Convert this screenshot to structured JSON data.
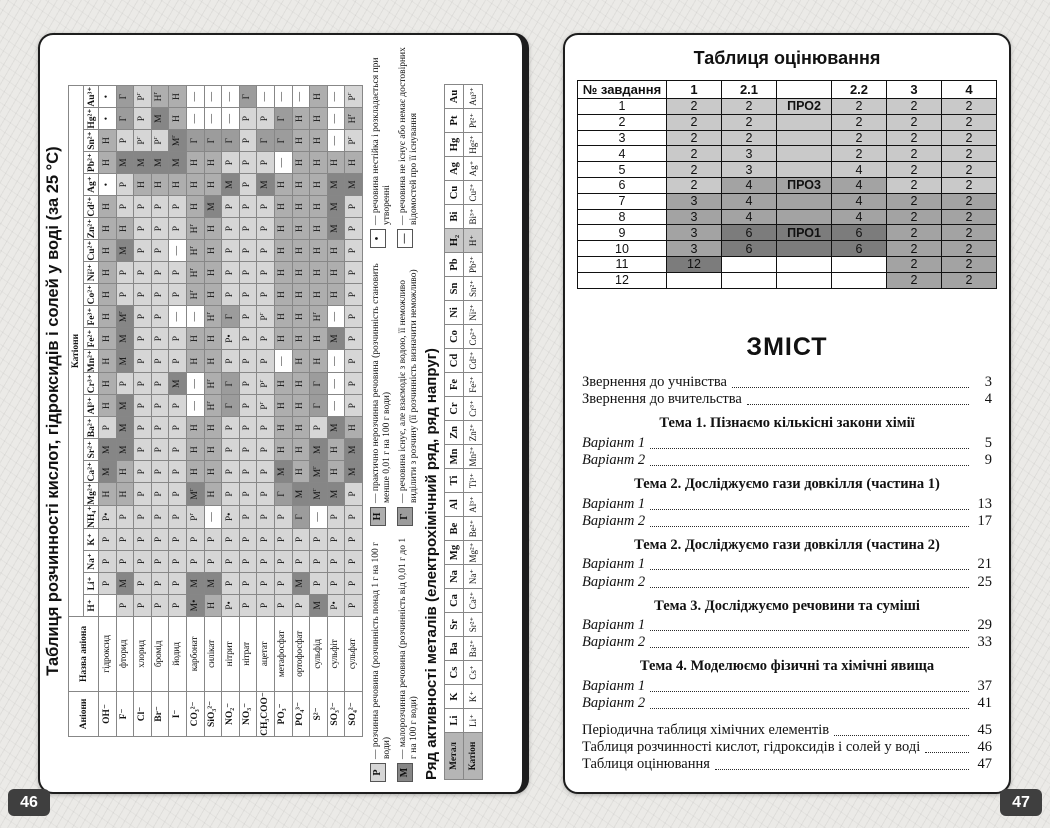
{
  "page_left": {
    "page_number": "46",
    "solubility": {
      "title": "Таблиця розчинності кислот, гідроксидів і солей у воді (за 25 °С)",
      "cations_header": "Катіони",
      "anions_header": "Аніони",
      "anion_name_header": "Назва аніона",
      "cations": [
        "H⁺",
        "Li⁺",
        "Na⁺",
        "K⁺",
        "NH₄⁺",
        "Mg²⁺",
        "Ca²⁺",
        "Sr²⁺",
        "Ba²⁺",
        "Al³⁺",
        "Cr³⁺",
        "Mn²⁺",
        "Fe²⁺",
        "Fe³⁺",
        "Co²⁺",
        "Ni²⁺",
        "Cu²⁺",
        "Zn²⁺",
        "Cd²⁺",
        "Ag⁺",
        "Pb²⁺",
        "Sn²⁺",
        "Hg²⁺",
        "Au³⁺"
      ],
      "rows": [
        {
          "formula": "OH⁻",
          "name": "гідроксид",
          "cells": [
            "",
            "Р",
            "Р",
            "Р",
            "Р•",
            "Н",
            "М",
            "М",
            "Р",
            "Н",
            "Н",
            "Н",
            "Н",
            "Н",
            "Н",
            "Н",
            "Н",
            "Н",
            "Н",
            "•",
            "Н",
            "Н",
            "•",
            "•"
          ]
        },
        {
          "formula": "F⁻",
          "name": "фторид",
          "cells": [
            "Р",
            "М",
            "Р",
            "Р",
            "Р",
            "Н",
            "Н",
            "М",
            "М",
            "М",
            "Р",
            "М",
            "М",
            "Мг",
            "Р",
            "Р",
            "М",
            "Н",
            "Р",
            "Р",
            "М",
            "Р",
            "Г",
            "Г"
          ]
        },
        {
          "formula": "Cl⁻",
          "name": "хлорид",
          "cells": [
            "Р",
            "Р",
            "Р",
            "Р",
            "Р",
            "Р",
            "Р",
            "Р",
            "Р",
            "Р",
            "Р",
            "Р",
            "Р",
            "Р",
            "Р",
            "Р",
            "Р",
            "Р",
            "Р",
            "Н",
            "М",
            "Рг",
            "Р",
            "Рг"
          ]
        },
        {
          "formula": "Br⁻",
          "name": "бромід",
          "cells": [
            "Р",
            "Р",
            "Р",
            "Р",
            "Р",
            "Р",
            "Р",
            "Р",
            "Р",
            "Р",
            "Р",
            "Р",
            "Р",
            "Р",
            "Р",
            "Р",
            "Р",
            "Р",
            "Р",
            "Н",
            "М",
            "Рг",
            "М",
            "Нг"
          ]
        },
        {
          "formula": "I⁻",
          "name": "йодид",
          "cells": [
            "Р",
            "Р",
            "Р",
            "Р",
            "Р",
            "Р",
            "Р",
            "Р",
            "Р",
            "Р",
            "М",
            "Р",
            "Р",
            "—",
            "Р",
            "Р",
            "—",
            "Р",
            "Р",
            "Н",
            "М",
            "Мг",
            "Н",
            "Н"
          ]
        },
        {
          "formula": "CO₃²⁻",
          "name": "карбонат",
          "cells": [
            "М•",
            "М",
            "Р",
            "Р",
            "Рг",
            "Мг",
            "Н",
            "Н",
            "Н",
            "—",
            "—",
            "Н",
            "Н",
            "—",
            "Нг",
            "Нг",
            "Нг",
            "Нг",
            "Н",
            "Н",
            "Н",
            "Г",
            "—",
            "—"
          ]
        },
        {
          "formula": "SiO₃²⁻",
          "name": "силікат",
          "cells": [
            "Н",
            "М",
            "Р",
            "Р",
            "—",
            "Н",
            "Н",
            "Н",
            "Н",
            "Нг",
            "Нг",
            "Н",
            "Н",
            "Нг",
            "Н",
            "Н",
            "Н",
            "Н",
            "М",
            "Н",
            "Н",
            "Г",
            "—",
            "—"
          ]
        },
        {
          "formula": "NO₂⁻",
          "name": "нітрит",
          "cells": [
            "Р•",
            "Р",
            "Р",
            "Р",
            "Р•",
            "Р",
            "Р",
            "Р",
            "Р",
            "Г",
            "Г",
            "Р",
            "Р•",
            "Г",
            "Р",
            "Р",
            "Р",
            "Р",
            "Р",
            "М",
            "Р",
            "Г",
            "—",
            "—"
          ]
        },
        {
          "formula": "NO₃⁻",
          "name": "нітрат",
          "cells": [
            "Р",
            "Р",
            "Р",
            "Р",
            "Р",
            "Р",
            "Р",
            "Р",
            "Р",
            "Р",
            "Р",
            "Р",
            "Р",
            "Р",
            "Р",
            "Р",
            "Р",
            "Р",
            "Р",
            "Р",
            "Р",
            "Р",
            "Р",
            "Г"
          ]
        },
        {
          "formula": "CH₃COO⁻",
          "name": "ацетат",
          "cells": [
            "Р",
            "Р",
            "Р",
            "Р",
            "Р",
            "Р",
            "Р",
            "Р",
            "Р",
            "Рг",
            "Рг",
            "Р",
            "Р",
            "Рг",
            "Р",
            "Р",
            "Р",
            "Р",
            "Р",
            "М",
            "Р",
            "Г",
            "Р",
            "—"
          ]
        },
        {
          "formula": "PO₃⁻",
          "name": "метафосфат",
          "cells": [
            "Р",
            "Р",
            "Р",
            "Р",
            "Р",
            "Г",
            "М",
            "Н",
            "Н",
            "Н",
            "Н",
            "—",
            "Н",
            "Н",
            "Н",
            "Н",
            "Н",
            "Н",
            "Н",
            "Н",
            "—",
            "Г",
            "Г",
            "—"
          ]
        },
        {
          "formula": "PO₄³⁻",
          "name": "ортофосфат",
          "cells": [
            "Р",
            "М",
            "Р",
            "Р",
            "Г",
            "М",
            "Н",
            "Н",
            "Н",
            "Н",
            "Н",
            "Н",
            "Н",
            "Н",
            "Н",
            "Н",
            "Н",
            "Н",
            "Н",
            "Н",
            "Н",
            "Н",
            "Н",
            "—"
          ]
        },
        {
          "formula": "S²⁻",
          "name": "сульфід",
          "cells": [
            "М",
            "Р",
            "Р",
            "Р",
            "—",
            "Мг",
            "Мг",
            "М",
            "Р",
            "Г",
            "Г",
            "Н",
            "Н",
            "Нг",
            "Н",
            "Н",
            "Н",
            "Н",
            "Н",
            "Н",
            "Н",
            "Н",
            "Н",
            "Н"
          ]
        },
        {
          "formula": "SO₃²⁻",
          "name": "сульфіт",
          "cells": [
            "Р•",
            "Р",
            "Р",
            "Р",
            "Р",
            "М",
            "Н",
            "Н",
            "М",
            "—",
            "—",
            "—",
            "М",
            "—",
            "Н",
            "Н",
            "Н",
            "М",
            "М",
            "М",
            "Н",
            "—",
            "—",
            "—"
          ]
        },
        {
          "formula": "SO₄²⁻",
          "name": "сульфат",
          "cells": [
            "Р",
            "Р",
            "Р",
            "Р",
            "Р",
            "Р",
            "М",
            "М",
            "Н",
            "Р",
            "Р",
            "Р",
            "Р",
            "Р",
            "Р",
            "Р",
            "Р",
            "Р",
            "Р",
            "М",
            "Н",
            "Рг",
            "Нг",
            "Рг"
          ]
        }
      ],
      "value_colors": {
        "Р": "#d6d6d6",
        "М": "#868686",
        "Н": "#aeaeae",
        "Г": "#9c9c9c"
      },
      "legend": [
        {
          "symbol": "Р",
          "color": "#d6d6d6",
          "text": "— розчинна речовина (розчинність понад 1 г на 100 г води)"
        },
        {
          "symbol": "М",
          "color": "#868686",
          "text": "— малорозчинна речовина (розчинність від 0,01 г до 1 г на 100 г води)"
        },
        {
          "symbol": "Н",
          "color": "#aeaeae",
          "text": "— практично нерозчинна речовина (розчинність становить менше 0,01 г на 100 г води)"
        },
        {
          "symbol": "Г",
          "color": "#9c9c9c",
          "text": "— речовина існує, але взаємодіє з водою, її неможливо виділити з розчину (її розчинність визначити неможливо)"
        },
        {
          "symbol": "•",
          "color": "#ffffff",
          "text": "— речовина нестійка і розкладається при утворенні"
        },
        {
          "symbol": "—",
          "color": "#ffffff",
          "text": "— речовина не існує або немає достовірних відомостей про її існування"
        }
      ]
    },
    "activity": {
      "title": "Ряд активності металів (електрохімічний ряд, ряд напруг)",
      "metal_label": "Метал",
      "cation_label": "Катіон",
      "metals": [
        "Li",
        "K",
        "Cs",
        "Ba",
        "Sr",
        "Ca",
        "Na",
        "Mg",
        "Be",
        "Al",
        "Ti",
        "Mn",
        "Zn",
        "Cr",
        "Fe",
        "Cd",
        "Co",
        "Ni",
        "Sn",
        "Pb",
        "H₂",
        "Bi",
        "Cu",
        "Ag",
        "Hg",
        "Pt",
        "Au"
      ],
      "ions": [
        "Li⁺",
        "K⁺",
        "Cs⁺",
        "Ba²⁺",
        "Sr²⁺",
        "Ca²⁺",
        "Na⁺",
        "Mg²⁺",
        "Be²⁺",
        "Al³⁺",
        "Ti³⁺",
        "Mn²⁺",
        "Zn²⁺",
        "Cr³⁺",
        "Fe²⁺",
        "Cd²⁺",
        "Co²⁺",
        "Ni²⁺",
        "Sn²⁺",
        "Pb²⁺",
        "H⁺",
        "Bi³⁺",
        "Cu²⁺",
        "Ag⁺",
        "Hg²⁺",
        "Pt²⁺",
        "Au³⁺"
      ],
      "highlight_index": 20
    }
  },
  "page_right": {
    "page_number": "47",
    "grading": {
      "title": "Таблиця оцінювання",
      "headers": [
        "№ завдання",
        "1",
        "2.1",
        "",
        "2.2",
        "3",
        "4"
      ],
      "shade_colors": {
        "l": "#c9c9c9",
        "m": "#a3a3a3",
        "d": "#7c7c7c",
        "w": "#ffffff"
      },
      "rows": [
        {
          "cells": [
            "1",
            "2",
            "2",
            "ПРО2",
            "2",
            "2",
            "2"
          ],
          "shades": [
            "l",
            "l",
            "l",
            "l",
            "l",
            "l"
          ]
        },
        {
          "cells": [
            "2",
            "2",
            "2",
            "",
            "2",
            "2",
            "2"
          ],
          "shades": [
            "l",
            "l",
            "l",
            "l",
            "l",
            "l"
          ]
        },
        {
          "cells": [
            "3",
            "2",
            "2",
            "",
            "2",
            "2",
            "2"
          ],
          "shades": [
            "l",
            "l",
            "l",
            "l",
            "l",
            "l"
          ]
        },
        {
          "cells": [
            "4",
            "2",
            "3",
            "",
            "2",
            "2",
            "2"
          ],
          "shades": [
            "l",
            "l",
            "l",
            "l",
            "l",
            "l"
          ]
        },
        {
          "cells": [
            "5",
            "2",
            "3",
            "",
            "4",
            "2",
            "2"
          ],
          "shades": [
            "l",
            "l",
            "l",
            "l",
            "l",
            "l"
          ]
        },
        {
          "cells": [
            "6",
            "2",
            "4",
            "ПРО3",
            "4",
            "2",
            "2"
          ],
          "shades": [
            "l",
            "m",
            "m",
            "m",
            "l",
            "l"
          ]
        },
        {
          "cells": [
            "7",
            "3",
            "4",
            "",
            "4",
            "2",
            "2"
          ],
          "shades": [
            "m",
            "m",
            "m",
            "m",
            "m",
            "m"
          ]
        },
        {
          "cells": [
            "8",
            "3",
            "4",
            "",
            "4",
            "2",
            "2"
          ],
          "shades": [
            "m",
            "m",
            "m",
            "m",
            "m",
            "m"
          ]
        },
        {
          "cells": [
            "9",
            "3",
            "6",
            "ПРО1",
            "6",
            "2",
            "2"
          ],
          "shades": [
            "m",
            "d",
            "d",
            "d",
            "m",
            "m"
          ]
        },
        {
          "cells": [
            "10",
            "3",
            "6",
            "",
            "6",
            "2",
            "2"
          ],
          "shades": [
            "m",
            "d",
            "d",
            "d",
            "m",
            "m"
          ]
        },
        {
          "cells": [
            "11",
            "12",
            "",
            "",
            "",
            "2",
            "2"
          ],
          "shades": [
            "d",
            "w",
            "w",
            "w",
            "m",
            "m"
          ]
        },
        {
          "cells": [
            "12",
            "",
            "",
            "",
            "",
            "2",
            "2"
          ],
          "shades": [
            "w",
            "w",
            "w",
            "w",
            "m",
            "m"
          ]
        }
      ]
    },
    "toc": {
      "title": "ЗМІСТ",
      "items": [
        {
          "t": "entry",
          "label": "Звернення до учнівства",
          "page": "3",
          "italic": false
        },
        {
          "t": "entry",
          "label": "Звернення до вчительства",
          "page": "4",
          "italic": false
        },
        {
          "t": "heading",
          "label": "Тема 1. Пізнаємо кількісні закони хімії"
        },
        {
          "t": "entry",
          "label": "Варіант 1",
          "page": "5",
          "italic": true
        },
        {
          "t": "entry",
          "label": "Варіант 2",
          "page": "9",
          "italic": true
        },
        {
          "t": "heading",
          "label": "Тема 2. Досліджуємо гази довкілля (частина 1)"
        },
        {
          "t": "entry",
          "label": "Варіант 1",
          "page": "13",
          "italic": true
        },
        {
          "t": "entry",
          "label": "Варіант 2",
          "page": "17",
          "italic": true
        },
        {
          "t": "heading",
          "label": "Тема 2. Досліджуємо гази довкілля (частина 2)"
        },
        {
          "t": "entry",
          "label": "Варіант 1",
          "page": "21",
          "italic": true
        },
        {
          "t": "entry",
          "label": "Варіант 2",
          "page": "25",
          "italic": true
        },
        {
          "t": "heading",
          "label": "Тема 3. Досліджуємо речовини та суміші"
        },
        {
          "t": "entry",
          "label": "Варіант 1",
          "page": "29",
          "italic": true
        },
        {
          "t": "entry",
          "label": "Варіант 2",
          "page": "33",
          "italic": true
        },
        {
          "t": "heading",
          "label": "Тема 4. Моделюємо фізичні та хімічні явища"
        },
        {
          "t": "entry",
          "label": "Варіант 1",
          "page": "37",
          "italic": true
        },
        {
          "t": "entry",
          "label": "Варіант 2",
          "page": "41",
          "italic": true
        },
        {
          "t": "entry",
          "label": "Періодична таблиця хімічних елементів",
          "page": "45",
          "italic": false,
          "gap": true
        },
        {
          "t": "entry",
          "label": "Таблиця розчинності кислот, гідроксидів і солей у воді",
          "page": "46",
          "italic": false
        },
        {
          "t": "entry",
          "label": "Таблиця оцінювання",
          "page": "47",
          "italic": false
        }
      ]
    }
  }
}
